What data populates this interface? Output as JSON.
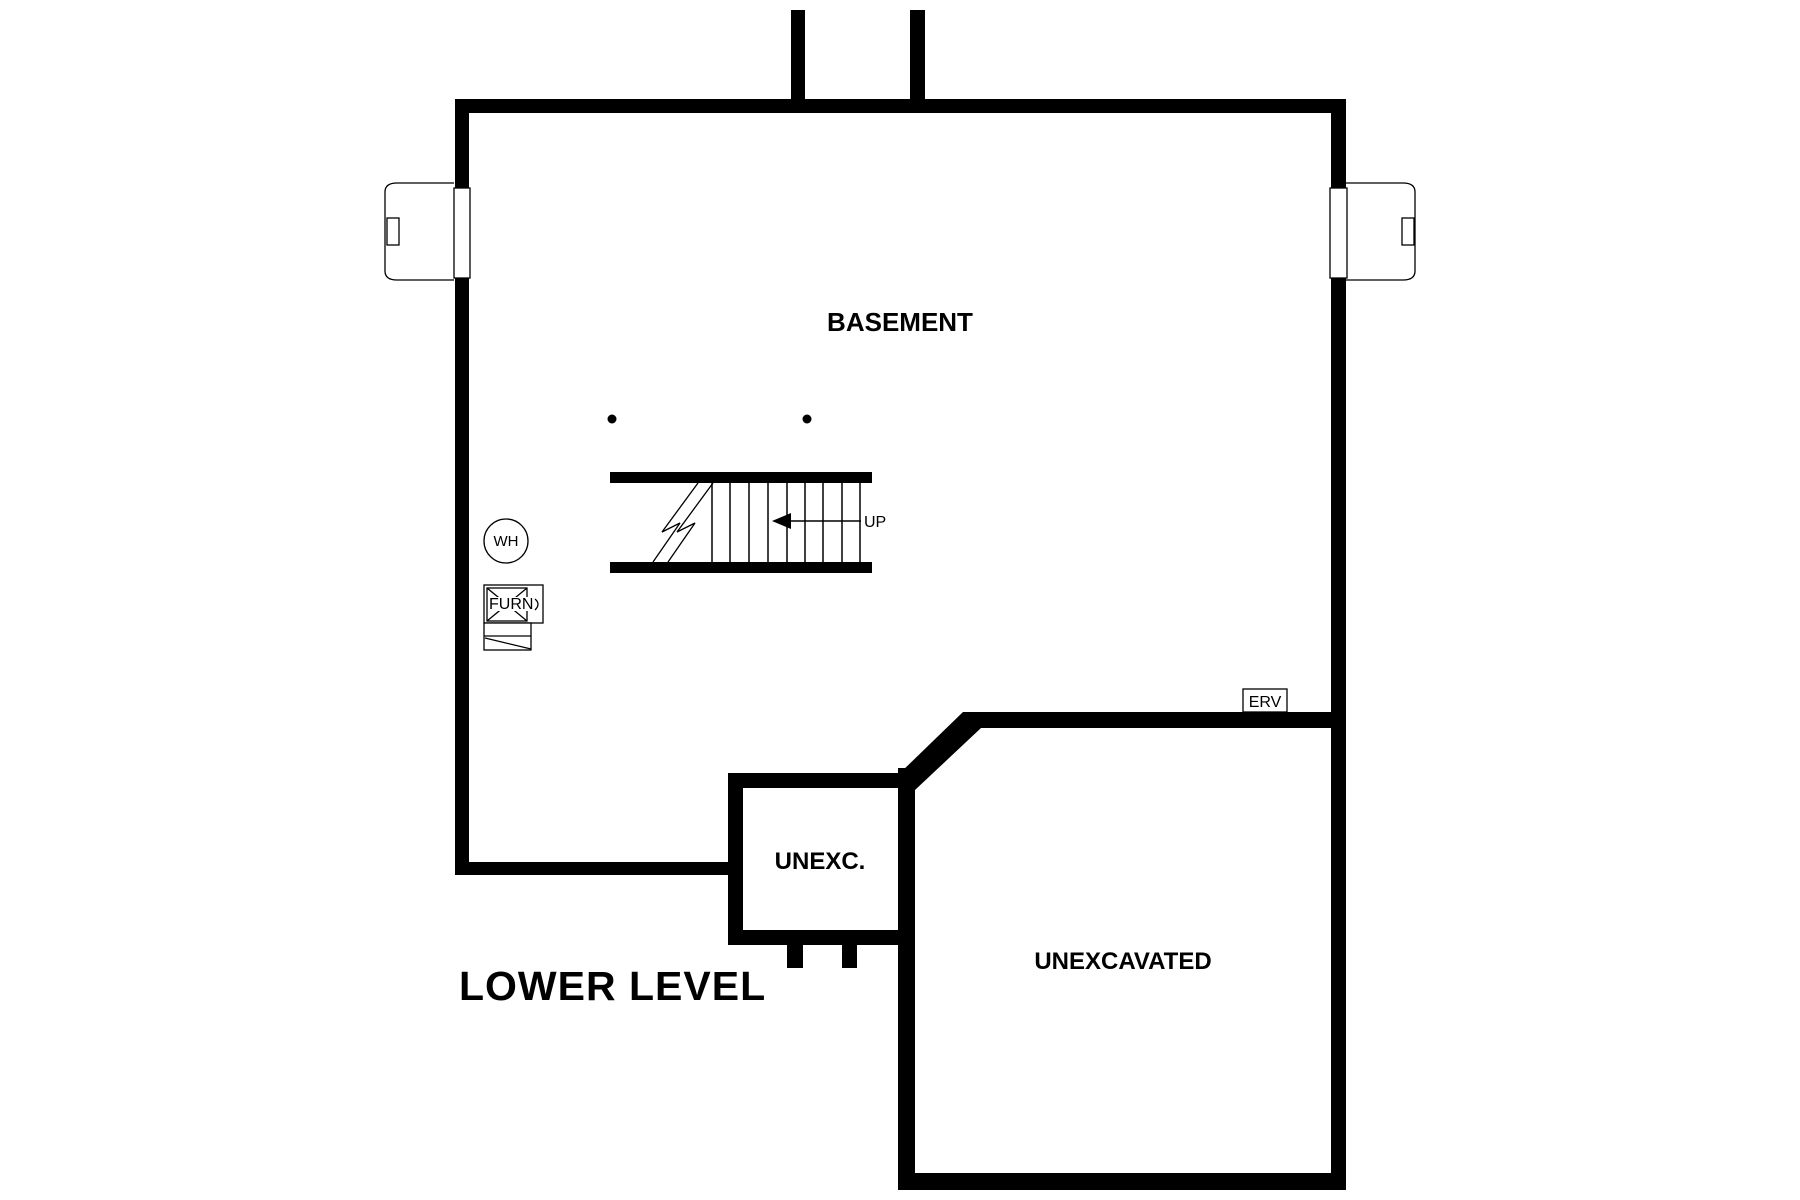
{
  "page_title": "LOWER LEVEL",
  "rooms": {
    "basement": {
      "label": "BASEMENT"
    },
    "unexc": {
      "label": "UNEXC."
    },
    "unexcavated": {
      "label": "UNEXCAVATED"
    }
  },
  "stairs": {
    "direction_label": "UP"
  },
  "equipment": {
    "water_heater": {
      "label": "WH"
    },
    "furnace": {
      "label": "FURN"
    },
    "erv": {
      "label": "ERV"
    }
  },
  "colors": {
    "wall": "#000000",
    "background": "#ffffff",
    "thin_line": "#000000"
  }
}
